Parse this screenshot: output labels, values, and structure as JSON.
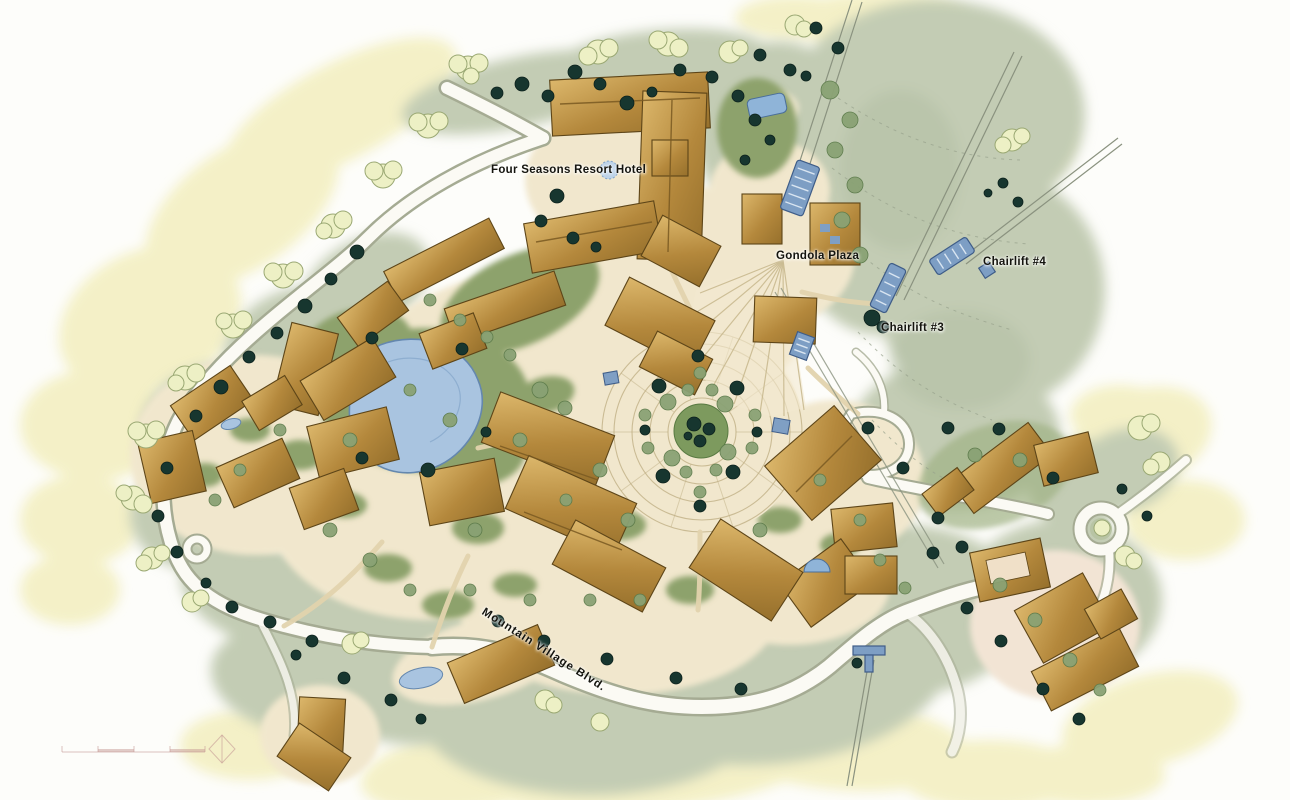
{
  "map": {
    "type": "illustrated-resort-site-plan",
    "labels": {
      "hotel": "Four Seasons Resort Hotel",
      "gondola_plaza": "Gondola Plaza",
      "chairlift_3": "Chairlift #3",
      "chairlift_4": "Chairlift #4",
      "boulevard": "Mountain Village Blvd."
    },
    "features": {
      "gondola_terminal_icon": "blue gondola terminal with rungs",
      "chairlift_3_terminal_icon": "blue chairlift terminal",
      "chairlift_4_terminal_icon": "blue chairlift terminal",
      "lower_lift_terminal_icon": "small blue lift terminal",
      "pond_icon": "irregular blue pond",
      "central_plaza_icon": "circular plaza with concentric rings",
      "roundabout_icon": "traffic circle with planted island",
      "scale_bar_icon": "graphic scale bar (tick text illegible)",
      "north_arrow_icon": "diamond north arrow"
    },
    "colors": {
      "background": "#fdfdfa",
      "wash_yellow": "#f3efc1",
      "slope_sage": "#c3ccb4",
      "meadow_sage": "#b2bfa4",
      "village_cream": "#f1e7cd",
      "lawn_green": "#8da26c",
      "roof_tan_light": "#dcb76b",
      "roof_tan_dark": "#b4883c",
      "roof_outline": "#5d4518",
      "pond_blue": "#a9c4e0",
      "lift_blue": "#7d9ec4",
      "tree_dark": "#17362f",
      "tree_medium": "#8aa274",
      "tree_pale": "#edf0c5",
      "road_fill": "#fbfaf4",
      "road_casing": "#a5ab93",
      "label_text": "#14140e"
    }
  }
}
